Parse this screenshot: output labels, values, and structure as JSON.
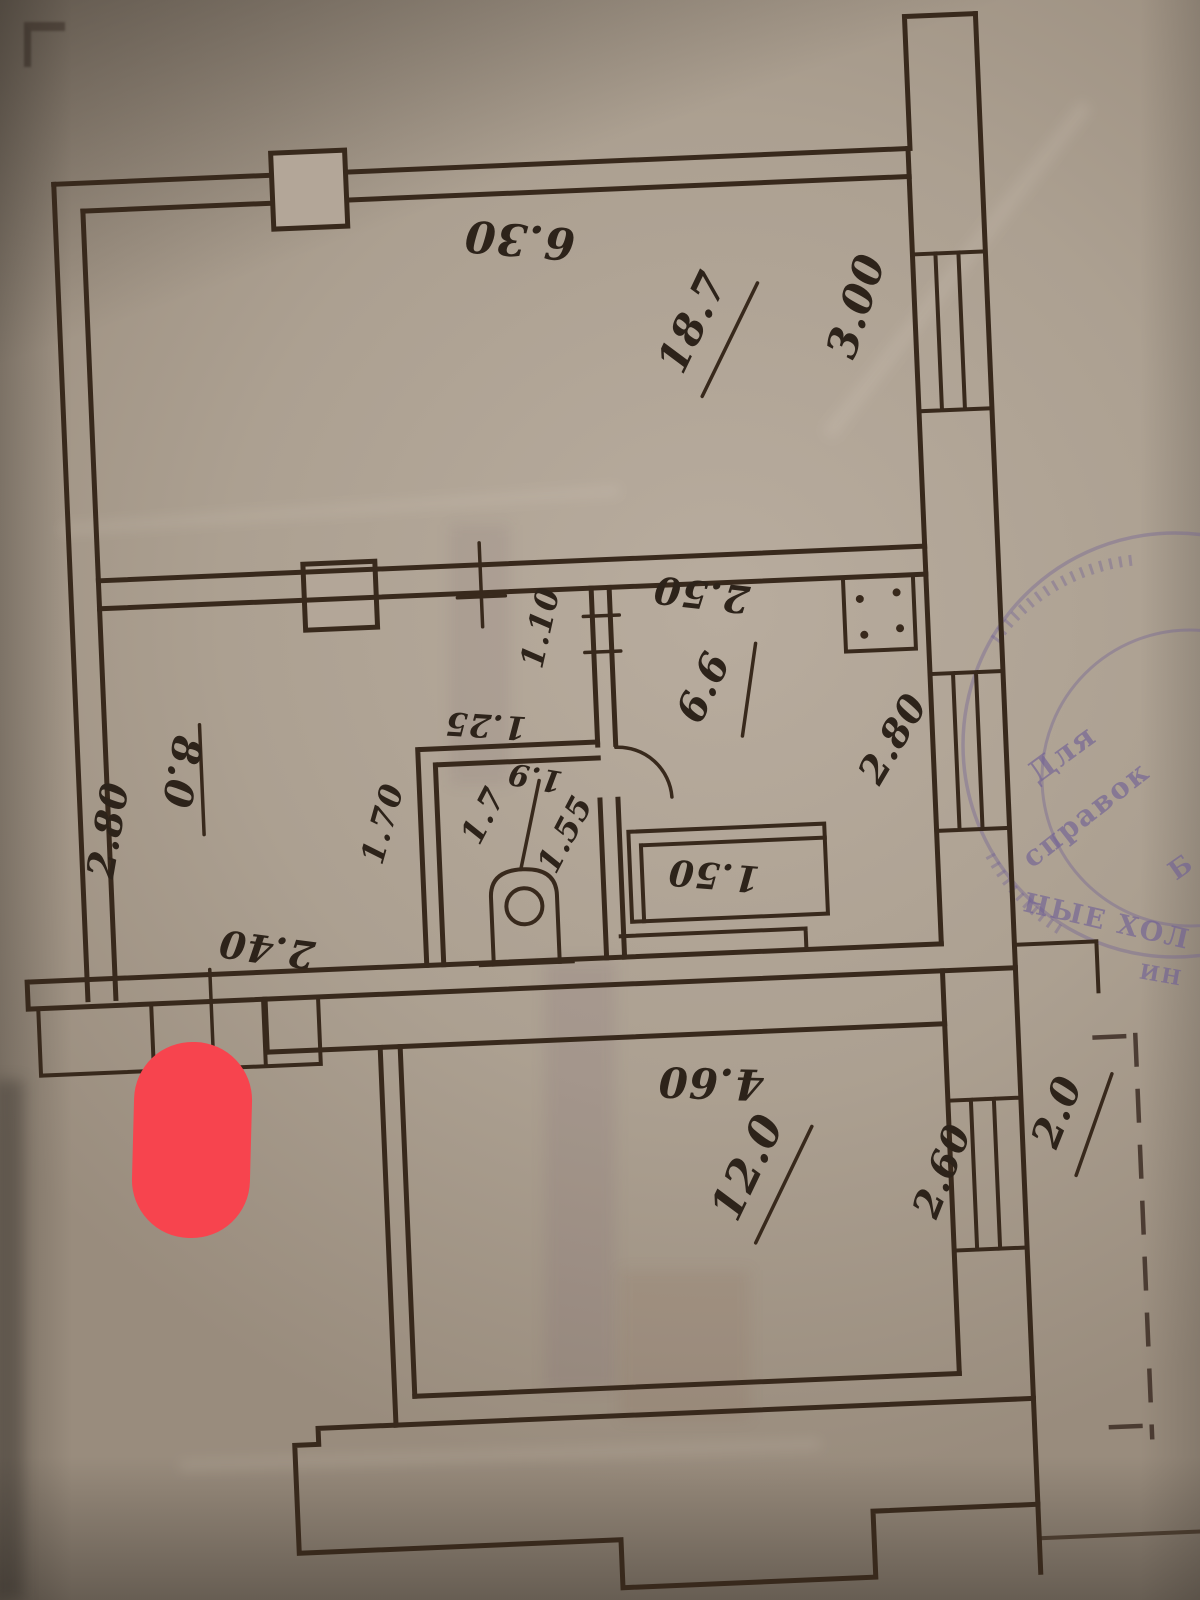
{
  "plan": {
    "labels": {
      "top_width": "6.30",
      "room_top_area": "18.7",
      "window_top": "3.00",
      "kitchen_top_width": "2.50",
      "kitchen_area": "6.6",
      "kitchen_window": "2.80",
      "hall_width": "1.10",
      "bath_width": "1.25",
      "dim_1_9": "1.9",
      "dim_1_55": "1.55",
      "bath_area": "1.7",
      "bath_depth": "1.70",
      "room_left_area": "8.0",
      "left_wall_height": "2.80",
      "hall_bottom_width": "2.40",
      "sink_width": "1.50",
      "room_bottom_width": "4.60",
      "room_bottom_area": "12.0",
      "window_bottom": "2.60",
      "balcony_width": "2.0"
    }
  },
  "stamp": {
    "line1": "Для",
    "line2": "справок",
    "letter": "Б",
    "arc_text": "НЫЕ ХОЛ",
    "arc_text2": "ИН",
    "color": "#6f5f96"
  },
  "annotation": {
    "marker_color": "#f7444e"
  },
  "colors": {
    "paper": "#aca091",
    "ink": "#38291c"
  }
}
